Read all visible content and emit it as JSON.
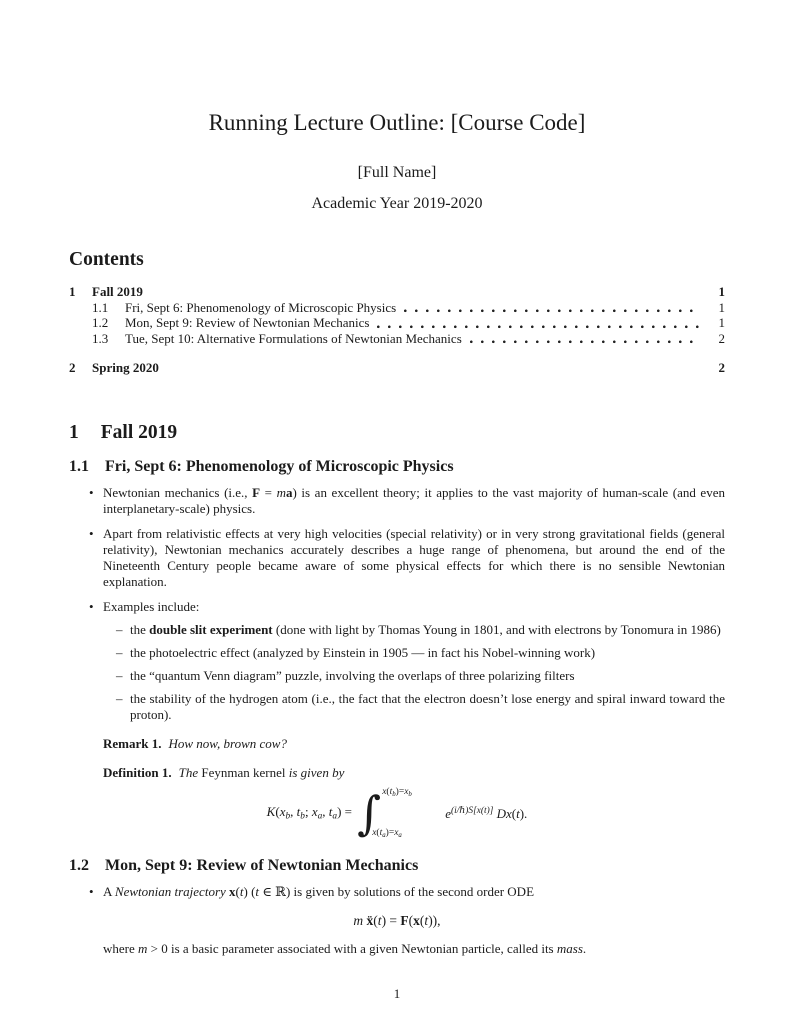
{
  "colors": {
    "background": "#ffffff",
    "text": "#1b1b1b"
  },
  "doc": {
    "title": "Running Lecture Outline: [Course Code]",
    "author": "[Full Name]",
    "date": "Academic Year 2019-2020"
  },
  "contents": {
    "heading": "Contents",
    "entries": [
      {
        "number": "1",
        "label": "Fall 2019",
        "page": "1"
      },
      {
        "number": "1.1",
        "label": "Fri, Sept 6: Phenomenology of Microscopic Physics",
        "page": "1"
      },
      {
        "number": "1.2",
        "label": "Mon, Sept 9: Review of Newtonian Mechanics",
        "page": "1"
      },
      {
        "number": "1.3",
        "label": "Tue, Sept 10: Alternative Formulations of Newtonian Mechanics",
        "page": "2"
      },
      {
        "number": "2",
        "label": "Spring 2020",
        "page": "2"
      }
    ]
  },
  "fall": {
    "number": "1",
    "title": "Fall 2019"
  },
  "phen": {
    "number": "1.1",
    "title": "Fri, Sept 6: Phenomenology of Microscopic Physics",
    "b1": [
      {
        "t": "Newtonian mechanics (i.e., "
      },
      {
        "t": "F",
        "s": "b"
      },
      {
        "t": " = "
      },
      {
        "t": "m",
        "s": "i"
      },
      {
        "t": "a",
        "s": "b"
      },
      {
        "t": ") is an excellent theory; it applies to the vast majority of human-scale (and even interplanetary-scale) physics."
      }
    ],
    "b2": [
      {
        "t": "Apart from relativistic effects at very high velocities (special relativity) or in very strong gravitational fields (general relativity), Newtonian mechanics accurately describes a huge range of phenomena, but around the end of the Nineteenth Century people became aware of some physical effects for which there is no sensible Newtonian explanation."
      }
    ],
    "b3": [
      {
        "t": "Examples include:"
      }
    ],
    "s1": [
      {
        "t": "the "
      },
      {
        "t": "double slit experiment",
        "s": "b"
      },
      {
        "t": " (done with light by Thomas Young in 1801, and with electrons by Tonomura in 1986)"
      }
    ],
    "s2": [
      {
        "t": "the photoelectric effect (analyzed by Einstein in 1905 — in fact his Nobel-winning work)"
      }
    ],
    "s3": [
      {
        "t": "the “quantum Venn diagram” puzzle, involving the overlaps of three polarizing filters"
      }
    ],
    "s4": [
      {
        "t": "the stability of the hydrogen atom (i.e., the fact that the electron doesn’t lose energy and spiral inward toward the proton)."
      }
    ],
    "remark_label": "Remark 1.",
    "remark_body": [
      {
        "t": "How now, brown cow?",
        "s": "i"
      }
    ],
    "definition_label": "Definition 1.",
    "definition_body": [
      {
        "t": "The ",
        "s": "i"
      },
      {
        "t": "Feynman kernel"
      },
      {
        "t": " is given by",
        "s": "i"
      }
    ],
    "kernel": {
      "lhs": [
        {
          "t": "K",
          "s": "i"
        },
        {
          "t": "("
        },
        {
          "t": "x",
          "s": "i"
        },
        {
          "t": "b",
          "s": "sub"
        },
        {
          "t": ", "
        },
        {
          "t": "t",
          "s": "i"
        },
        {
          "t": "b",
          "s": "sub"
        },
        {
          "t": "; "
        },
        {
          "t": "x",
          "s": "i"
        },
        {
          "t": "a",
          "s": "sub"
        },
        {
          "t": ", "
        },
        {
          "t": "t",
          "s": "i"
        },
        {
          "t": "a",
          "s": "sub"
        },
        {
          "t": ") = "
        }
      ],
      "integral_sign": "∫",
      "upper": [
        {
          "t": "x",
          "s": "i"
        },
        {
          "t": "("
        },
        {
          "t": "t",
          "s": "i"
        },
        {
          "t": "b",
          "s": "sub"
        },
        {
          "t": ")="
        },
        {
          "t": "x",
          "s": "i"
        },
        {
          "t": "b",
          "s": "sub"
        }
      ],
      "lower": [
        {
          "t": "x",
          "s": "i"
        },
        {
          "t": "("
        },
        {
          "t": "t",
          "s": "i"
        },
        {
          "t": "a",
          "s": "sub"
        },
        {
          "t": ")="
        },
        {
          "t": "x",
          "s": "i"
        },
        {
          "t": "a",
          "s": "sub"
        }
      ],
      "integrand": [
        {
          "t": "e",
          "s": "i"
        },
        {
          "t": "(i/ℏ)S[x(t)]",
          "s": "sup"
        },
        {
          "t": " "
        },
        {
          "t": "D",
          "s": "scr"
        },
        {
          "t": "x",
          "s": "i"
        },
        {
          "t": "("
        },
        {
          "t": "t",
          "s": "i"
        },
        {
          "t": ")."
        }
      ]
    }
  },
  "newt": {
    "number": "1.2",
    "title": "Mon, Sept 9: Review of Newtonian Mechanics",
    "b1": [
      {
        "t": "A "
      },
      {
        "t": "Newtonian trajectory",
        "s": "i"
      },
      {
        "t": " "
      },
      {
        "t": "x",
        "s": "b"
      },
      {
        "t": "("
      },
      {
        "t": "t",
        "s": "i"
      },
      {
        "t": ") ("
      },
      {
        "t": "t",
        "s": "i"
      },
      {
        "t": " ∈ ℝ) is given by solutions of the second order ODE"
      }
    ],
    "ode": [
      {
        "t": "m",
        "s": "i"
      },
      {
        "t": " "
      },
      {
        "t": "ẍ",
        "s": "b"
      },
      {
        "t": "("
      },
      {
        "t": "t",
        "s": "i"
      },
      {
        "t": ") = "
      },
      {
        "t": "F",
        "s": "b"
      },
      {
        "t": "("
      },
      {
        "t": "x",
        "s": "b"
      },
      {
        "t": "("
      },
      {
        "t": "t",
        "s": "i"
      },
      {
        "t": ")),"
      }
    ],
    "after": [
      {
        "t": "where "
      },
      {
        "t": "m",
        "s": "i"
      },
      {
        "t": " > 0 is a basic parameter associated with a given Newtonian particle, called its "
      },
      {
        "t": "mass",
        "s": "i"
      },
      {
        "t": "."
      }
    ]
  },
  "footer": {
    "page_number": "1"
  }
}
